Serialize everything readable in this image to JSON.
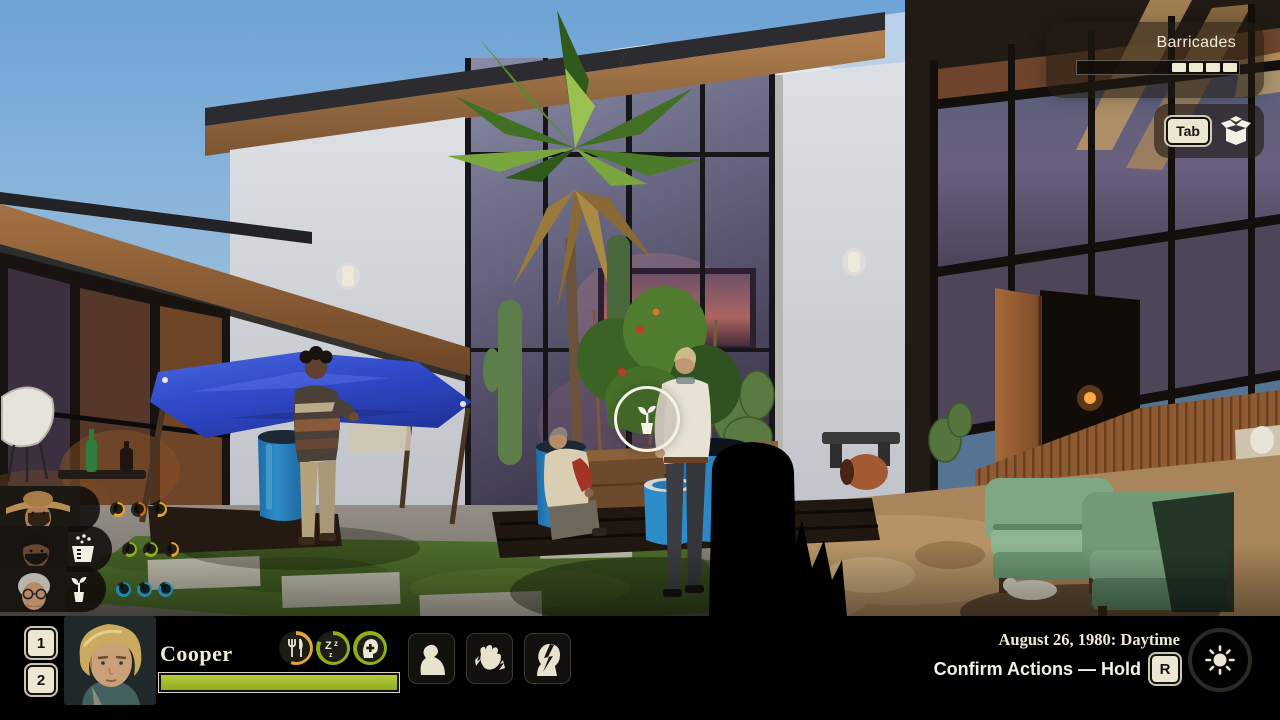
{
  "colors": {
    "cream": "#efe9d6",
    "accent_green": "#93ab21",
    "ring_yellow": "#e2a339",
    "ring_orange": "#cf6a1d",
    "ring_green": "#8fae1b",
    "ring_teal": "#1f89ad",
    "health_fill": "#a2bc2a"
  },
  "top_right": {
    "barricades": {
      "label": "Barricades",
      "segments_filled": 4
    },
    "inventory": {
      "key_label": "Tab",
      "icon": "open-box-icon"
    }
  },
  "party": {
    "members": [
      {
        "portrait": "man-with-cowboy-hat",
        "task_icon": null,
        "rings": [
          {
            "color": "#e2a339",
            "fill": 0.6
          },
          {
            "color": "#cf6a1d",
            "fill": 0.45
          },
          {
            "color": "#e2a339",
            "fill": 0.55
          }
        ]
      },
      {
        "portrait": "bearded-man",
        "task_icon": "washing-basket-icon",
        "rings": [
          {
            "color": "#8fae1b",
            "fill": 0.6
          },
          {
            "color": "#8fae1b",
            "fill": 0.65
          },
          {
            "color": "#e2a339",
            "fill": 0.5
          }
        ]
      },
      {
        "portrait": "elderly-woman-glasses",
        "task_icon": "potted-plant-icon",
        "rings": [
          {
            "color": "#1f89ad",
            "fill": 0.85
          },
          {
            "color": "#1f89ad",
            "fill": 0.85
          },
          {
            "color": "#1f89ad",
            "fill": 0.85
          }
        ]
      }
    ]
  },
  "active_character": {
    "hotkeys": [
      "1",
      "2"
    ],
    "name": "Cooper",
    "health_fill": 1,
    "needs": [
      {
        "icon": "food-icon",
        "color": "#e2a339",
        "fill": 0.55
      },
      {
        "icon": "sleep-icon",
        "color": "#8fae1b",
        "fill": 0.82
      },
      {
        "icon": "morale-icon",
        "color": "#8fae1b",
        "fill": 1
      }
    ],
    "status_effects": [
      "slumped-person-icon",
      "hand-cramp-icon",
      "head-pain-icon"
    ]
  },
  "bottom_right": {
    "date_line": "August 26, 1980: Daytime",
    "confirm_label": "Confirm Actions — Hold",
    "confirm_key": "R",
    "time_icon": "sun-icon"
  },
  "scene": {
    "interaction_marker": "potted-plant-icon",
    "planter_stencil": "THIS WAY"
  }
}
